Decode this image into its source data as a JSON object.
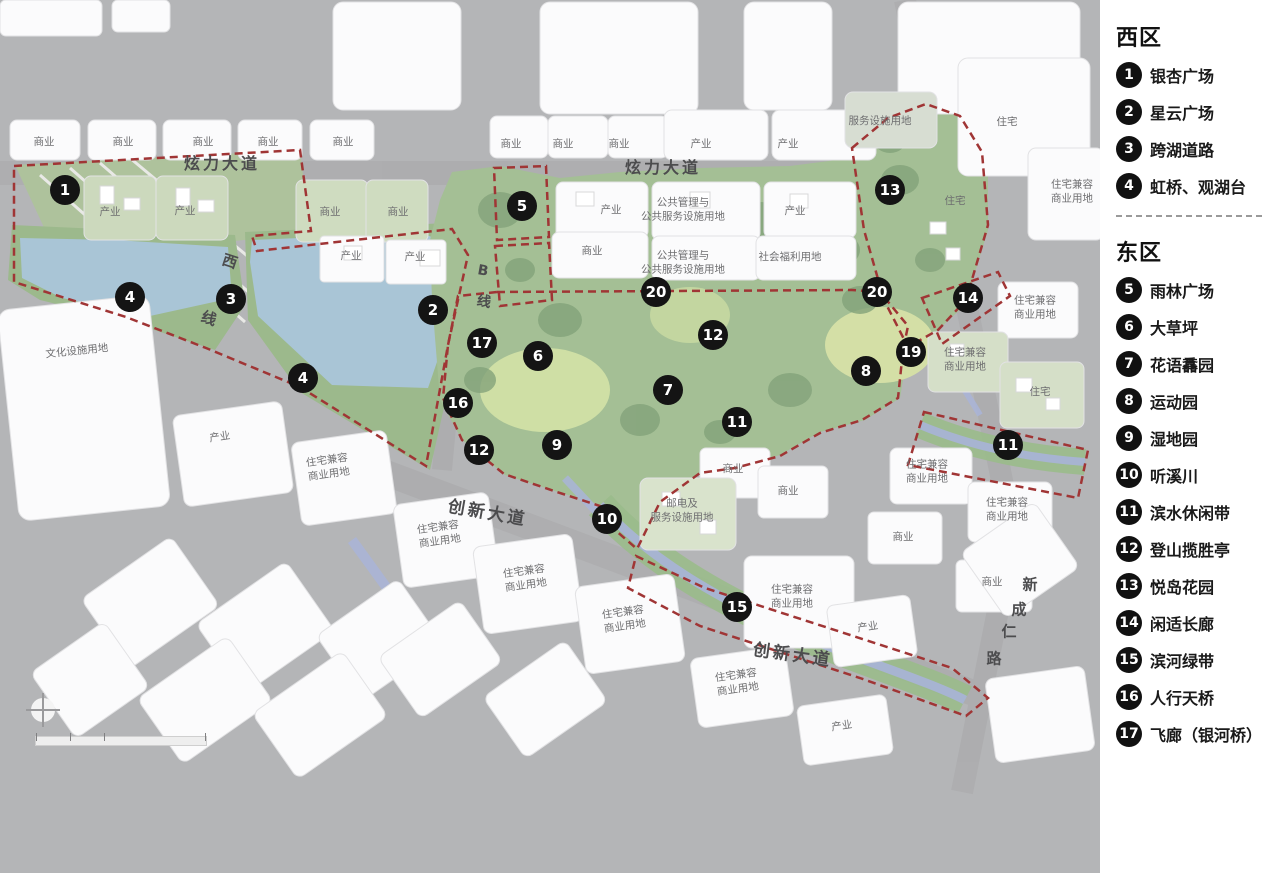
{
  "legend": {
    "sections": [
      {
        "title": "西区",
        "items": [
          {
            "num": "1",
            "label": "银杏广场"
          },
          {
            "num": "2",
            "label": "星云广场"
          },
          {
            "num": "3",
            "label": "跨湖道路"
          },
          {
            "num": "4",
            "label": "虹桥、观湖台"
          }
        ]
      },
      {
        "title": "东区",
        "items": [
          {
            "num": "5",
            "label": "雨林广场"
          },
          {
            "num": "6",
            "label": "大草坪"
          },
          {
            "num": "7",
            "label": "花语馫园"
          },
          {
            "num": "8",
            "label": "运动园"
          },
          {
            "num": "9",
            "label": "湿地园"
          },
          {
            "num": "10",
            "label": "听溪川"
          },
          {
            "num": "11",
            "label": "滨水休闲带"
          },
          {
            "num": "12",
            "label": "登山揽胜亭"
          },
          {
            "num": "13",
            "label": "悦岛花园"
          },
          {
            "num": "14",
            "label": "闲适长廊"
          },
          {
            "num": "15",
            "label": "滨河绿带"
          },
          {
            "num": "16",
            "label": "人行天桥"
          },
          {
            "num": "17",
            "label": "飞廊（银河桥）"
          }
        ]
      }
    ]
  },
  "map": {
    "markers": [
      {
        "num": "1",
        "x": 65,
        "y": 190
      },
      {
        "num": "2",
        "x": 433,
        "y": 310
      },
      {
        "num": "3",
        "x": 231,
        "y": 299
      },
      {
        "num": "4",
        "x": 130,
        "y": 297
      },
      {
        "num": "4",
        "x": 303,
        "y": 378
      },
      {
        "num": "5",
        "x": 522,
        "y": 206
      },
      {
        "num": "6",
        "x": 538,
        "y": 356
      },
      {
        "num": "7",
        "x": 668,
        "y": 390
      },
      {
        "num": "8",
        "x": 866,
        "y": 371
      },
      {
        "num": "9",
        "x": 557,
        "y": 445
      },
      {
        "num": "10",
        "x": 607,
        "y": 519
      },
      {
        "num": "11",
        "x": 737,
        "y": 422
      },
      {
        "num": "11",
        "x": 1008,
        "y": 445
      },
      {
        "num": "12",
        "x": 713,
        "y": 335
      },
      {
        "num": "12",
        "x": 479,
        "y": 450
      },
      {
        "num": "13",
        "x": 890,
        "y": 190
      },
      {
        "num": "14",
        "x": 968,
        "y": 298
      },
      {
        "num": "15",
        "x": 737,
        "y": 607
      },
      {
        "num": "16",
        "x": 458,
        "y": 403
      },
      {
        "num": "17",
        "x": 482,
        "y": 343
      },
      {
        "num": "19",
        "x": 911,
        "y": 352
      },
      {
        "num": "20",
        "x": 656,
        "y": 292
      },
      {
        "num": "20",
        "x": 877,
        "y": 292
      }
    ],
    "road_labels": [
      {
        "text": "炫力大道",
        "x": 222,
        "y": 162,
        "size": 16,
        "spacing": 3,
        "rot": 0
      },
      {
        "text": "炫力大道",
        "x": 663,
        "y": 166,
        "size": 16,
        "spacing": 3,
        "rot": 0
      },
      {
        "text": "创新大道",
        "x": 488,
        "y": 511,
        "size": 17,
        "spacing": 3,
        "rot": 10
      },
      {
        "text": "创新大道",
        "x": 793,
        "y": 653,
        "size": 17,
        "spacing": 3,
        "rot": 8
      },
      {
        "text": "西",
        "x": 230,
        "y": 261,
        "size": 15,
        "spacing": 0,
        "rot": 18
      },
      {
        "text": "线",
        "x": 209,
        "y": 318,
        "size": 15,
        "spacing": 0,
        "rot": 18
      },
      {
        "text": "B",
        "x": 483,
        "y": 271,
        "size": 14,
        "spacing": 0,
        "rot": 10
      },
      {
        "text": "线",
        "x": 484,
        "y": 301,
        "size": 14,
        "spacing": 0,
        "rot": 10
      },
      {
        "text": "新",
        "x": 1030,
        "y": 584,
        "size": 15,
        "spacing": 0,
        "rot": 0
      },
      {
        "text": "成",
        "x": 1019,
        "y": 609,
        "size": 15,
        "spacing": 0,
        "rot": 0
      },
      {
        "text": "仁",
        "x": 1009,
        "y": 631,
        "size": 15,
        "spacing": 0,
        "rot": 0
      },
      {
        "text": "路",
        "x": 994,
        "y": 658,
        "size": 15,
        "spacing": 0,
        "rot": 0
      }
    ],
    "area_labels": [
      {
        "text": "商业",
        "x": 44,
        "y": 143
      },
      {
        "text": "商业",
        "x": 123,
        "y": 143
      },
      {
        "text": "商业",
        "x": 203,
        "y": 143
      },
      {
        "text": "商业",
        "x": 268,
        "y": 143
      },
      {
        "text": "商业",
        "x": 343,
        "y": 143
      },
      {
        "text": "商业",
        "x": 511,
        "y": 145
      },
      {
        "text": "商业",
        "x": 563,
        "y": 145
      },
      {
        "text": "商业",
        "x": 619,
        "y": 145
      },
      {
        "text": "产业",
        "x": 701,
        "y": 145
      },
      {
        "text": "产业",
        "x": 788,
        "y": 145
      },
      {
        "text": "产业",
        "x": 110,
        "y": 213
      },
      {
        "text": "产业",
        "x": 185,
        "y": 212
      },
      {
        "text": "商业",
        "x": 330,
        "y": 213
      },
      {
        "text": "商业",
        "x": 398,
        "y": 213
      },
      {
        "text": "产业",
        "x": 351,
        "y": 257
      },
      {
        "text": "产业",
        "x": 415,
        "y": 258
      },
      {
        "text": "产业",
        "x": 611,
        "y": 211
      },
      {
        "text": "公共管理与\n公共服务设施用地",
        "x": 683,
        "y": 210
      },
      {
        "text": "产业",
        "x": 795,
        "y": 212
      },
      {
        "text": "商业",
        "x": 592,
        "y": 252
      },
      {
        "text": "公共管理与\n公共服务设施用地",
        "x": 683,
        "y": 263
      },
      {
        "text": "社会福利用地",
        "x": 790,
        "y": 258
      },
      {
        "text": "服务设施用地",
        "x": 880,
        "y": 122
      },
      {
        "text": "住宅",
        "x": 1007,
        "y": 123
      },
      {
        "text": "住宅",
        "x": 955,
        "y": 202
      },
      {
        "text": "住宅兼容\n商业用地",
        "x": 1072,
        "y": 192
      },
      {
        "text": "住宅兼容\n商业用地",
        "x": 1035,
        "y": 308
      },
      {
        "text": "住宅兼容\n商业用地",
        "x": 965,
        "y": 360
      },
      {
        "text": "住宅",
        "x": 1040,
        "y": 393
      },
      {
        "text": "文化设施用地",
        "x": 77,
        "y": 352,
        "rot": -6
      },
      {
        "text": "产业",
        "x": 220,
        "y": 438,
        "rot": -8
      },
      {
        "text": "住宅兼容\n商业用地",
        "x": 328,
        "y": 468,
        "rot": -8
      },
      {
        "text": "商业",
        "x": 733,
        "y": 470
      },
      {
        "text": "商业",
        "x": 788,
        "y": 492
      },
      {
        "text": "商业",
        "x": 903,
        "y": 538
      },
      {
        "text": "邮电及\n服务设施用地",
        "x": 682,
        "y": 511
      },
      {
        "text": "住宅兼容\n商业用地",
        "x": 439,
        "y": 535,
        "rot": -8
      },
      {
        "text": "住宅兼容\n商业用地",
        "x": 525,
        "y": 579,
        "rot": -8
      },
      {
        "text": "住宅兼容\n商业用地",
        "x": 624,
        "y": 620,
        "rot": -8
      },
      {
        "text": "住宅兼容\n商业用地",
        "x": 792,
        "y": 597
      },
      {
        "text": "住宅兼容\n商业用地",
        "x": 927,
        "y": 472
      },
      {
        "text": "住宅兼容\n商业用地",
        "x": 1007,
        "y": 510
      },
      {
        "text": "商业",
        "x": 992,
        "y": 583
      },
      {
        "text": "住宅兼容\n商业用地",
        "x": 737,
        "y": 683,
        "rot": -8
      },
      {
        "text": "产业",
        "x": 868,
        "y": 628,
        "rot": -8
      },
      {
        "text": "产业",
        "x": 842,
        "y": 727,
        "rot": -8
      }
    ]
  },
  "colors": {
    "boundary_red": "#a03535",
    "marker_black": "#141414",
    "lake_blue": "#a9c5d6",
    "river_blue": "#a9b4d8",
    "park_green": "#a4bf95",
    "meadow_green": "#cfdfa5",
    "background_gray": "#b4b5b7",
    "panel_white": "#ffffff"
  }
}
